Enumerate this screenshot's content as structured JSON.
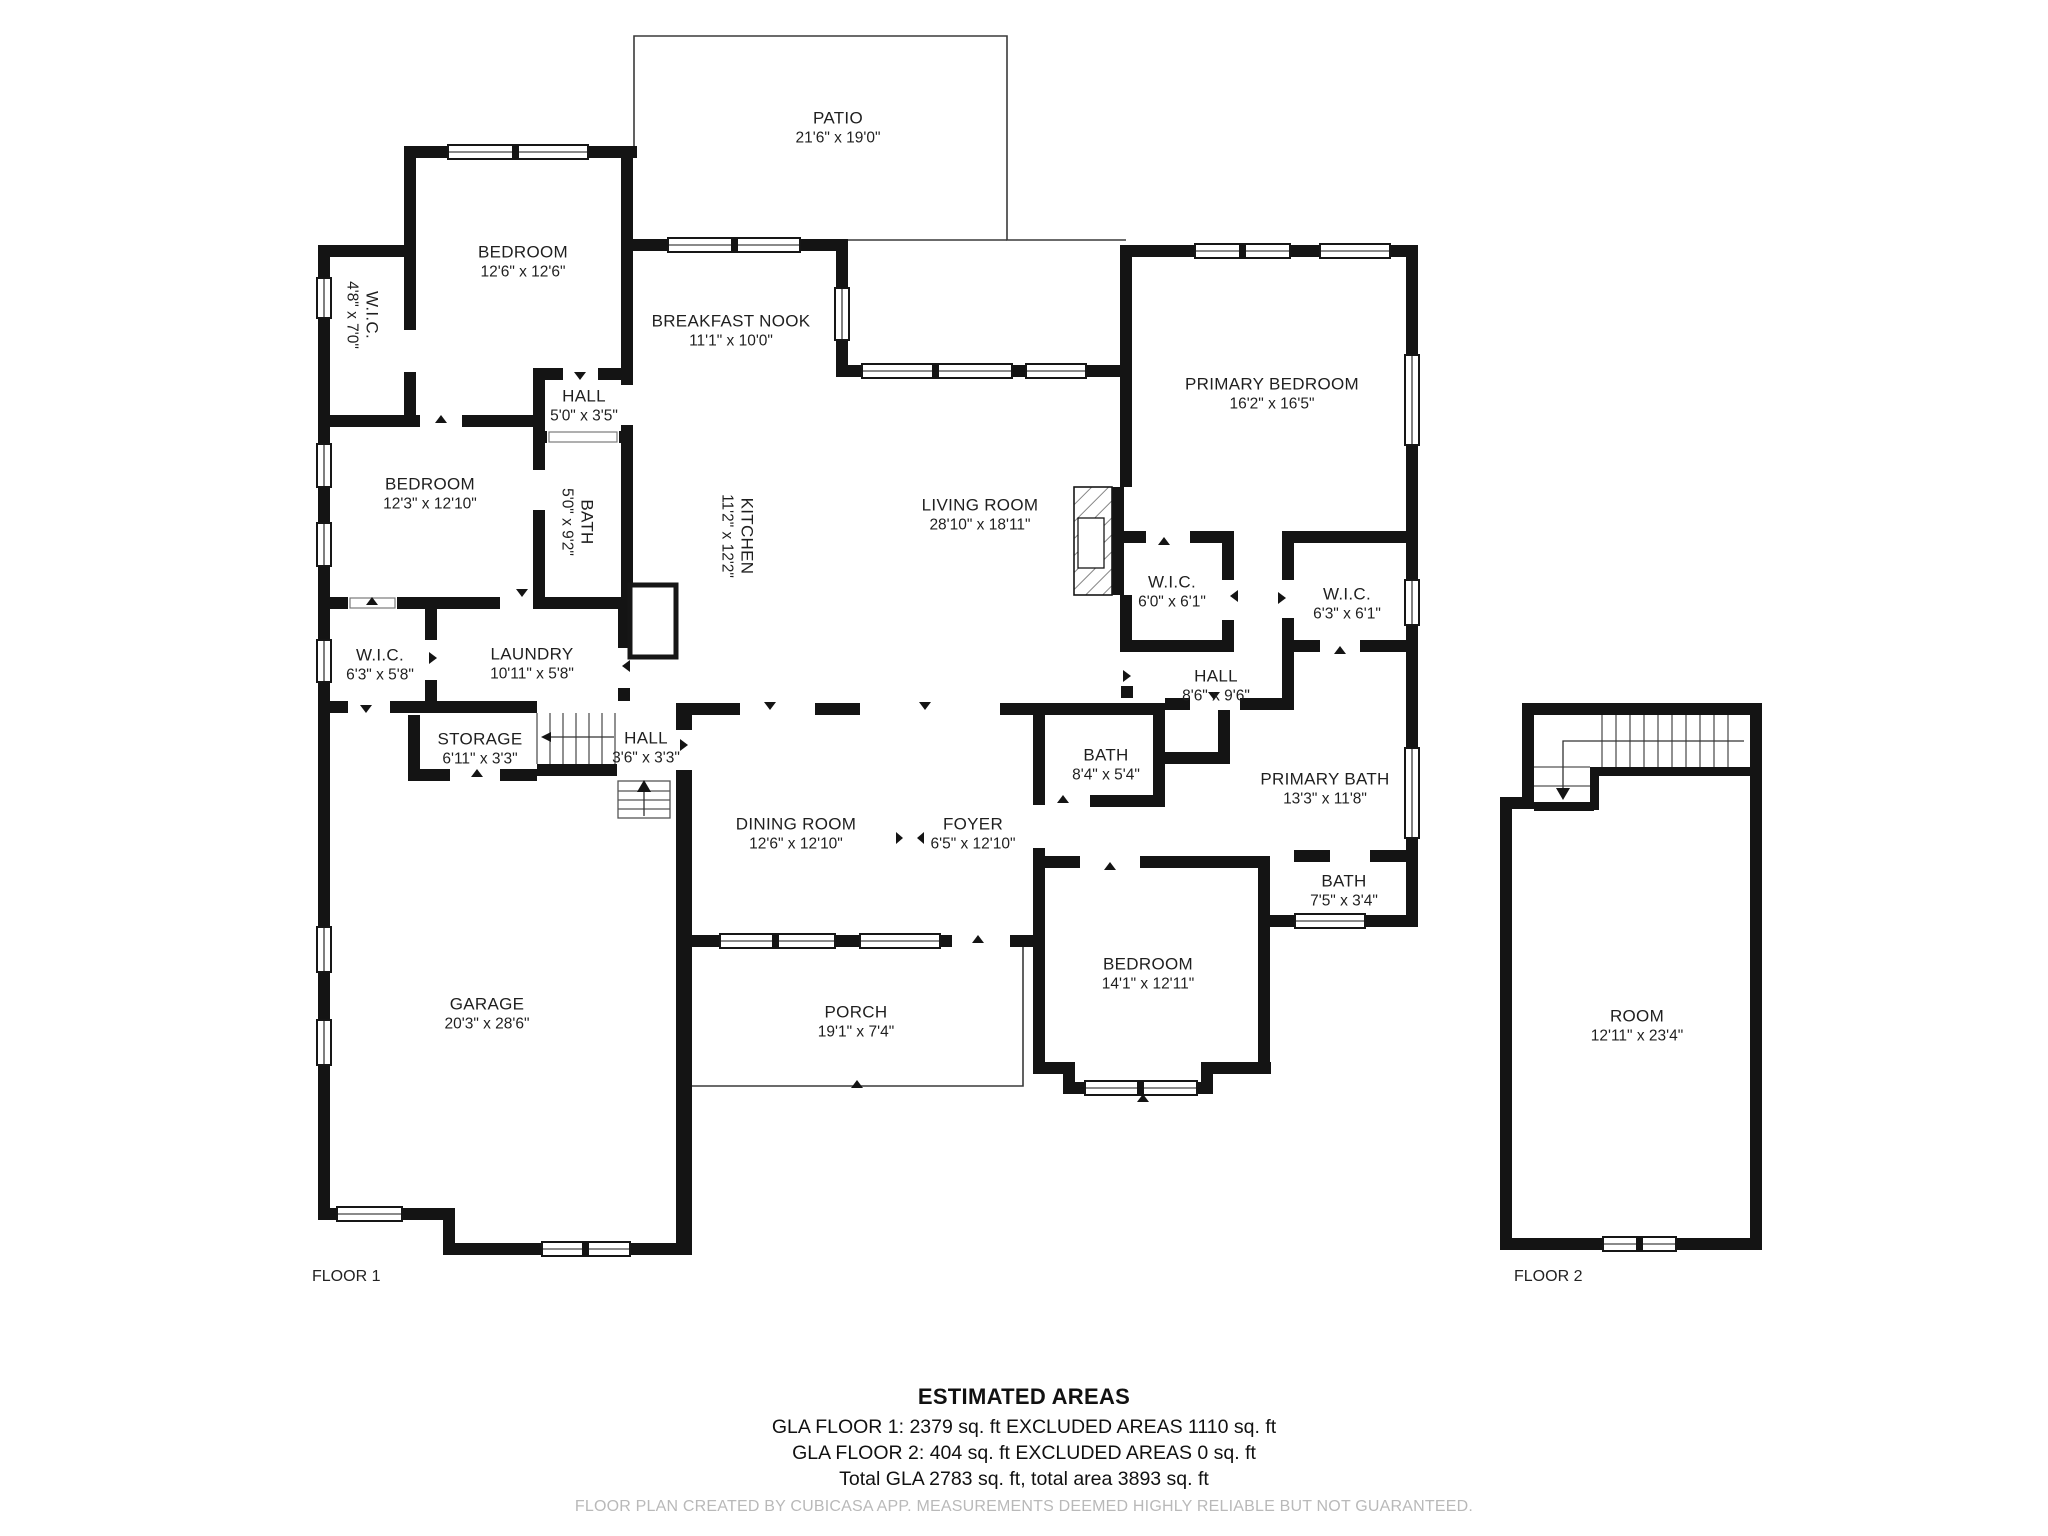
{
  "floor_labels": {
    "floor1": "FLOOR 1",
    "floor2": "FLOOR 2"
  },
  "rooms": [
    {
      "name": "PATIO",
      "dims": "21'6\" x 19'0\""
    },
    {
      "name": "BEDROOM",
      "dims": "12'6\" x 12'6\""
    },
    {
      "name": "W.I.C.",
      "dims": "4'8\" x 7'0\""
    },
    {
      "name": "BREAKFAST NOOK",
      "dims": "11'1\" x 10'0\""
    },
    {
      "name": "HALL",
      "dims": "5'0\" x 3'5\""
    },
    {
      "name": "BEDROOM",
      "dims": "12'3\" x 12'10\""
    },
    {
      "name": "BATH",
      "dims": "5'0\" x 9'2\""
    },
    {
      "name": "KITCHEN",
      "dims": "11'2\" x 12'2\""
    },
    {
      "name": "LIVING ROOM",
      "dims": "28'10\" x 18'11\""
    },
    {
      "name": "PRIMARY BEDROOM",
      "dims": "16'2\" x 16'5\""
    },
    {
      "name": "W.I.C.",
      "dims": "6'0\" x 6'1\""
    },
    {
      "name": "W.I.C.",
      "dims": "6'3\" x 6'1\""
    },
    {
      "name": "HALL",
      "dims": "8'6\" x 9'6\""
    },
    {
      "name": "LAUNDRY",
      "dims": "10'11\" x 5'8\""
    },
    {
      "name": "W.I.C.",
      "dims": "6'3\" x 5'8\""
    },
    {
      "name": "STORAGE",
      "dims": "6'11\" x 3'3\""
    },
    {
      "name": "HALL",
      "dims": "3'6\" x 3'3\""
    },
    {
      "name": "DINING ROOM",
      "dims": "12'6\" x 12'10\""
    },
    {
      "name": "FOYER",
      "dims": "6'5\" x 12'10\""
    },
    {
      "name": "BATH",
      "dims": "8'4\" x 5'4\""
    },
    {
      "name": "PRIMARY BATH",
      "dims": "13'3\" x 11'8\""
    },
    {
      "name": "BATH",
      "dims": "7'5\" x 3'4\""
    },
    {
      "name": "BEDROOM",
      "dims": "14'1\" x 12'11\""
    },
    {
      "name": "GARAGE",
      "dims": "20'3\" x 28'6\""
    },
    {
      "name": "PORCH",
      "dims": "19'1\" x 7'4\""
    },
    {
      "name": "ROOM",
      "dims": "12'11\" x 23'4\""
    }
  ],
  "estimated_areas": {
    "heading": "ESTIMATED AREAS",
    "line1": "GLA FLOOR 1: 2379 sq. ft EXCLUDED AREAS 1110 sq. ft",
    "line2": "GLA FLOOR 2: 404 sq. ft EXCLUDED AREAS 0 sq. ft",
    "line3": "Total GLA 2783 sq. ft, total area 3893 sq. ft"
  },
  "footer_note": "FLOOR PLAN CREATED BY CUBICASA APP. MEASUREMENTS DEEMED HIGHLY RELIABLE BUT NOT GUARANTEED.",
  "colors": {
    "wall": "#141414",
    "thin_line": "#3a3a3a",
    "label_text": "#1f1f1f",
    "muted_text": "#b9b9b9",
    "background": "#ffffff"
  }
}
